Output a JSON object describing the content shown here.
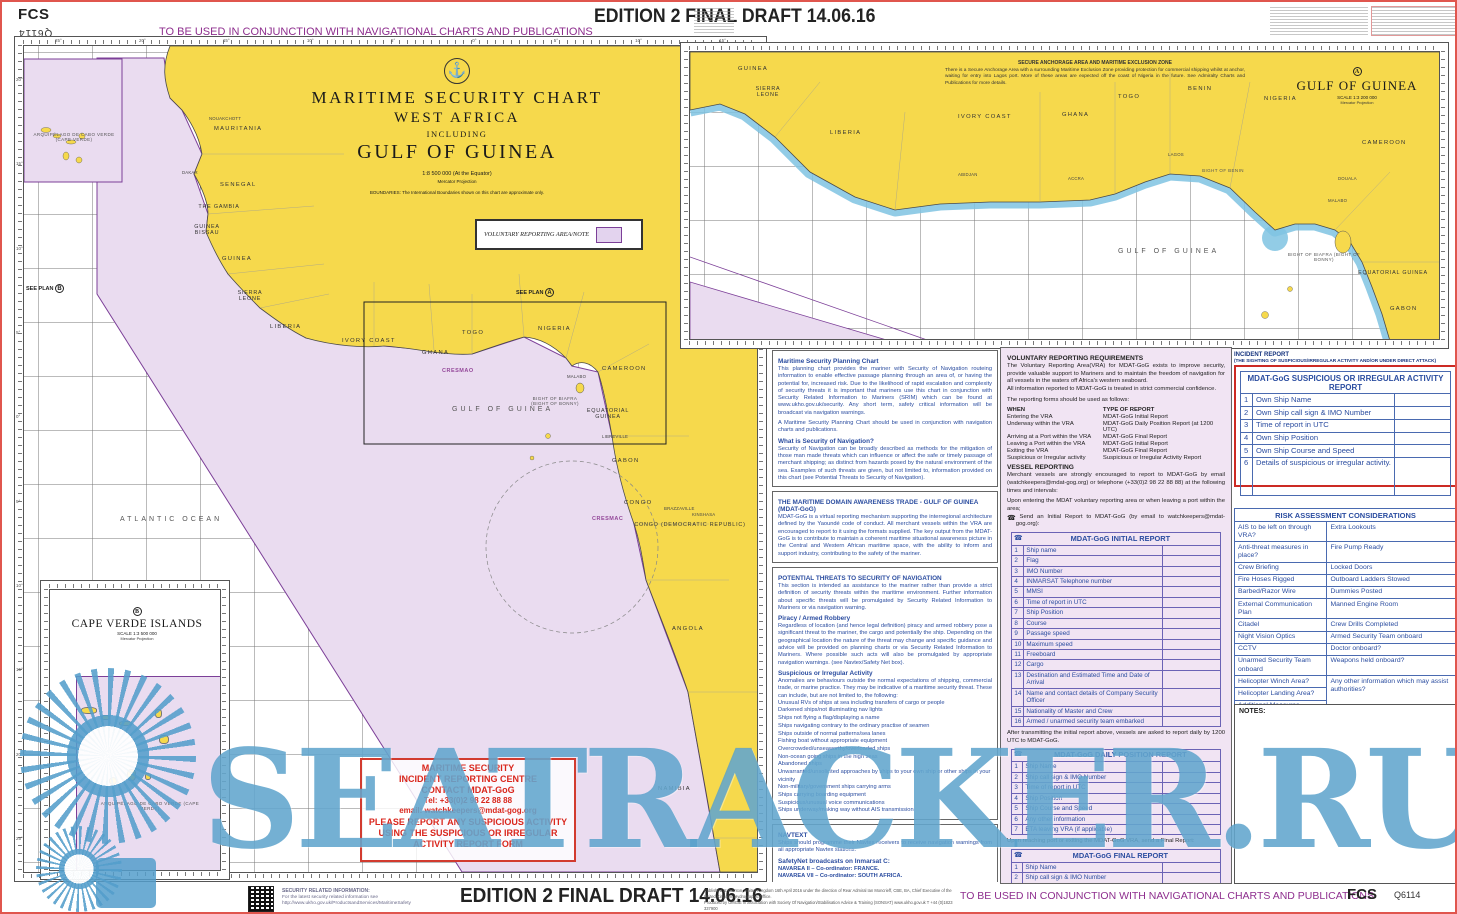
{
  "header": {
    "fcs": "FCS",
    "chart_number": "Q6114",
    "edition": "EDITION 2 FINAL DRAFT 14.06.16",
    "usage_note": "TO BE USED IN CONJUNCTION WITH NAVIGATIONAL CHARTS AND PUBLICATIONS"
  },
  "title_block": {
    "line1": "MARITIME SECURITY CHART",
    "line2": "WEST AFRICA",
    "line3": "INCLUDING",
    "line4": "GULF OF GUINEA",
    "scale": "1:8 500 000 (At the Equator)",
    "projection": "Mercator Projection",
    "boundaries": "BOUNDARIES:  The International Boundaries shown on this chart are approximate only.",
    "anchor_icon": "⚓"
  },
  "legend_box": {
    "label": "VOLUNTARY REPORTING AREA/NOTE"
  },
  "main_map": {
    "labels": [
      "MAURITANIA",
      "NOUAKCHOTT",
      "SENEGAL",
      "DAKAR",
      "THE GAMBIA",
      "GUINEA BISSAU",
      "GUINEA",
      "SIERRA LEONE",
      "LIBERIA",
      "IVORY COAST",
      "GHANA",
      "TOGO",
      "NIGERIA",
      "CAMEROON",
      "MALABO",
      "BIGHT OF BIAFRA (BIGHT OF BONNY)",
      "EQUATORIAL GUINEA",
      "LIBREVILLE",
      "GABON",
      "CONGO",
      "BRAZZAVILLE",
      "KINSHASA",
      "CONGO (DEMOCRATIC REPUBLIC)",
      "CRESMAC",
      "CRESMAO",
      "ANGOLA",
      "NAMIBIA",
      "GULF OF GUINEA",
      "ATLANTIC OCEAN",
      "ARQUIPÉLAGO DE CABO VERDE (CAPE VERDE)"
    ],
    "see_plan": "SEE PLAN",
    "plan_a_badge": "A",
    "plan_b_badge": "B",
    "lon_labels": [
      "25°",
      "20°",
      "15°",
      "10°",
      "5°",
      "0°",
      "5°",
      "10°",
      "15°"
    ],
    "lat_labels": [
      "20°",
      "15°",
      "10°",
      "5°",
      "0°",
      "5°",
      "10°",
      "15°",
      "20°",
      "25°"
    ]
  },
  "inset_a": {
    "badge": "A",
    "title": "GULF OF GUINEA",
    "scale": "SCALE 1:3 200 000",
    "projection": "Mercator Projection",
    "note_title": "SECURE ANCHORAGE AREA AND MARITIME EXCLUSION ZONE",
    "note_body": "There is a Secure Anchorage Area with a surrounding Maritime Exclusion Zone providing protection for commercial shipping whilst at anchor, waiting for entry into Lagos port. More of these areas are expected off the coast of Nigeria in the future. See Admiralty Charts and Publications for more details.",
    "labels": [
      "GUINEA",
      "SIERRA LEONE",
      "LIBERIA",
      "IVORY COAST",
      "GHANA",
      "TOGO",
      "BENIN",
      "NIGERIA",
      "CAMEROON",
      "BIGHT OF BENIN",
      "MALABO",
      "GULF OF GUINEA",
      "BIGHT OF BIAFRA (BIGHT OF BONNY)",
      "EQUATORIAL GUINEA",
      "GABON",
      "ABIDJAN",
      "ACCRA",
      "LAGOS",
      "DOUALA"
    ]
  },
  "inset_b": {
    "badge": "B",
    "title": "CAPE VERDE ISLANDS",
    "scale": "SCALE 1:3 500 000",
    "projection": "Mercator Projection",
    "islands_label": "ARQUIPÉLAGO DE CABO VERDE (CAPE VERDE)"
  },
  "info_panel": {
    "s1_title": "Maritime Security Planning Chart",
    "s1_body": "This planning chart provides the mariner with Security of Navigation routeing information to enable effective passage planning through an area of, or having the potential for, increased risk. Due to the likelihood of rapid escalation and complexity of security threats it is important that mariners use this chart in conjunction with Security Related Information to Mariners (SRIM) which can be found at www.ukho.gov.uk/security. Any short term, safety critical information will be broadcast via navigation warnings.",
    "s1_body2": "A Maritime Security Planning Chart should be used in conjunction with navigation charts and publications.",
    "s2_title": "What is Security of Navigation?",
    "s2_body": "Security of Navigation can be broadly described as methods for the mitigation of those man made threats which can influence or affect the safe or timely passage of merchant shipping; as distinct from hazards posed by the natural environment of the sea. Examples of such threats are given, but not limited to, information provided on this chart (see Potential Threats to Security of Navigation).",
    "s3_title": "THE MARITIME DOMAIN AWARENESS TRADE - GULF OF GUINEA (MDAT-GoG)",
    "s3_body": "MDAT-GoG is a virtual reporting mechanism supporting the interregional architecture defined by the Yaoundé code of conduct. All merchant vessels within the VRA are encouraged to report to it using the formats supplied. The key output from the MDAT-GoG is to contribute to maintain a coherent maritime situational awareness picture in the Central and Western African maritime space, with the ability to inform and support industry, contributing to the safety of the mariner.",
    "s4_title": "POTENTIAL THREATS TO SECURITY OF NAVIGATION",
    "s4_body": "This section is intended as assistance to the mariner rather than provide a strict definition of security threats within the maritime environment. Further information about specific threats will be promulgated by Security Related Information to Mariners or via navigation warning.",
    "s5_title": "Piracy / Armed Robbery",
    "s5_body": "Regardless of location (and hence legal definition) piracy and armed robbery pose a significant threat to the mariner, the cargo and potentially the ship. Depending on the geographical location the nature of the threat may change and specific guidance and advice will be provided on planning charts or via Security Related Information to Mariners. Where possible such acts will also be promulgated by appropriate navigation warnings. (see Navtex/Safety Net box).",
    "s6_title": "Suspicious or Irregular Activity",
    "s6_body": "Anomalies are behaviours outside the normal expectations of shipping, commercial trade, or marine practice. They may be indicative of a maritime security threat. These can include, but are not limited to, the following:",
    "s6_items": [
      "Unusual RVs of ships at sea including transfers of cargo or people",
      "Darkened ships/not illuminating nav lights",
      "Ships not flying a flag/displaying a name",
      "Ships navigating contrary to the ordinary practise of seamen",
      "Ships outside of normal patterns/sea lanes",
      "Fishing boat without appropriate equipment",
      "Overcrowded/unseaworthy/overloaded ships",
      "Non-ocean going ships in the high seas",
      "Abandoned ships",
      "Unwarranted/unsolicited approaches by ships to your own ship or other ships in your vicinity",
      "Non-military/government ships carrying arms",
      "Ships carrying boarding equipment",
      "Suspicious/unusual voice communications",
      "Ships underway/making way without AIS transmission"
    ],
    "s7_title": "NAVTEXT",
    "s7_body": "Ships should programme their Navtex receivers to receive navigation warnings from all appropriate Navtex stations.",
    "s7_sub": "SafetyNet broadcasts on Inmarsat C:",
    "s7_navarea2": "NAVAREA II – Co-ordinator: FRANCE.",
    "s7_navarea7": "NAVAREA VII – Co-ordinator: SOUTH AFRICA.",
    "s7_body2": "See Admiralty List of Radio Signals (ALRS) Volume 5 (NP285) for full details, scheduled transmission times, etc.",
    "s7_body3": "Ships in the Maritime Domain Awareness Trade - Gulf of Guinea Voluntary Reporting Area (MDAT-GoG VRA) should ensure that their Inmarsat C terminals are set to recieve navigational warnings from both NAVAREA II and VII to be sure that they recieve all of the relevant navigational warnings."
  },
  "reporting": {
    "title": "VOLUNTARY REPORTING REQUIREMENTS",
    "intro": "The Voluntary Reporting Area(VRA) for MDAT-GoG exists to improve security, provide valuable support to Mariners and to maintain the freedom of navigation for all vessels in the waters off Africa's western seaboard.",
    "intro2": "All information reported to MDAT-GoG is treated in strict commercial confidence.",
    "forms_intro": "The reporting forms should be used as follows:",
    "when_header": "WHEN",
    "type_header": "TYPE OF REPORT",
    "when_rows": [
      [
        "Entering the VRA",
        "MDAT-GoG Initial Report"
      ],
      [
        "Underway within the VRA",
        "MDAT-GoG Daily Position Report (at 1200 UTC)"
      ],
      [
        "Arriving at a Port within the VRA",
        "MDAT-GoG Final Report"
      ],
      [
        "Leaving a Port within the VRA",
        "MDAT-GoG Initial Report"
      ],
      [
        "Exiting the VRA",
        "MDAT-GoG Final Report"
      ],
      [
        "Suspicious or Irregular activity",
        "Suspicious or Irregular Activity Report"
      ]
    ],
    "vessel_title": "VESSEL REPORTING",
    "vessel_body": "Merchant vessels are strongly encouraged to report to MDAT-GoG by email (watchkeepers@mdat-gog.org) or telephone (+33(0)2 98 22 88 88) at the following times and intervals:",
    "upon_entering": "Upon entering the MDAT voluntary reporting area or when leaving a port within the area;",
    "send_initial": "Send an Initial Report to MDAT-GoG (by email to watchkeepers@mdat-gog.org):",
    "initial": {
      "title": "MDAT-GoG INITIAL REPORT",
      "rows": [
        [
          "1",
          "Ship name"
        ],
        [
          "2",
          "Flag"
        ],
        [
          "3",
          "IMO Number"
        ],
        [
          "4",
          "INMARSAT  Telephone number"
        ],
        [
          "5",
          "MMSI"
        ],
        [
          "6",
          "Time of report in UTC"
        ],
        [
          "7",
          "Ship Position"
        ],
        [
          "8",
          "Course"
        ],
        [
          "9",
          "Passage speed"
        ],
        [
          "10",
          "Maximum speed"
        ],
        [
          "11",
          "Freeboard"
        ],
        [
          "12",
          "Cargo"
        ],
        [
          "13",
          "Destination and Estimated Time and Date of Arrival"
        ],
        [
          "14",
          "Name and contact details of Company Security Officer"
        ],
        [
          "15",
          "Nationality of Master and Crew"
        ],
        [
          "16",
          "Armed / unarmed security team embarked"
        ]
      ]
    },
    "after_initial": "After transmitting the initial report above, vessels are asked to report daily by 1200 UTC to MDAT-GoG.",
    "daily": {
      "title": "MDAT-GoG DAILY POSITION REPORT",
      "rows": [
        [
          "1",
          "Ship Name"
        ],
        [
          "2",
          "Ship call sign & IMO Number"
        ],
        [
          "3",
          "Time of report in UTC"
        ],
        [
          "4",
          "Ship Position"
        ],
        [
          "5",
          "Ship Course and Speed"
        ],
        [
          "6",
          "Any other information"
        ],
        [
          "7",
          "ETA leaving VRA (if applicable)"
        ]
      ]
    },
    "upon_reaching": "Upon reaching port or exiting the MDAT-GoG VRA, send a Final Report:",
    "final": {
      "title": "MDAT-GoG FINAL REPORT",
      "rows": [
        [
          "1",
          "Ship Name"
        ],
        [
          "2",
          "Ship call sign & IMO Number"
        ],
        [
          "3",
          "Time of report in UTC"
        ],
        [
          "4",
          "Port/anchorage, or position when leaving GoG VRA"
        ]
      ]
    }
  },
  "incident": {
    "title": "INCIDENT REPORT",
    "subtitle": "(THE SIGHTING OF SUSPICIOUS/IRREGULAR ACTIVITY AND/OR UNDER DIRECT ATTACK)",
    "table_title": "MDAT-GoG SUSPICIOUS OR IRREGULAR ACTIVITY REPORT",
    "rows": [
      [
        "1",
        "Own Ship Name"
      ],
      [
        "2",
        "Own Ship call sign & IMO Number"
      ],
      [
        "3",
        "Time of report in UTC"
      ],
      [
        "4",
        "Own Ship Position"
      ],
      [
        "5",
        "Own Ship Course and Speed"
      ],
      [
        "6",
        "Details of suspicious or irregular activity."
      ]
    ]
  },
  "risk": {
    "title": "RISK ASSESSMENT CONSIDERATIONS",
    "rows": [
      [
        "AIS to be left on through VRA?",
        "Extra Lookouts"
      ],
      [
        "Anti-threat measures in place?",
        "Fire Pump Ready"
      ],
      [
        "Crew Briefing",
        "Locked Doors"
      ],
      [
        "Fire Hoses Rigged",
        "Outboard Ladders Stowed"
      ],
      [
        "Barbed/Razor Wire",
        "Dummies Posted"
      ],
      [
        "External Communication Plan",
        "Manned Engine Room"
      ],
      [
        "Citadel",
        "Crew Drills Completed"
      ],
      [
        "Night Vision Optics",
        "Armed Security Team onboard"
      ],
      [
        "CCTV",
        "Doctor onboard?"
      ],
      [
        "Unarmed Security Team onboard",
        "Weapons held onboard?"
      ],
      [
        "Helicopter Winch Area?",
        {
          "t": "Any other information which may assist authorities?",
          "rs": 3
        }
      ],
      [
        "Helicopter Landing Area?",
        null
      ],
      [
        "Additional Measures",
        null
      ]
    ]
  },
  "notes_label": "NOTES:",
  "contact_box": {
    "l1": "MARITIME SECURITY",
    "l2": "INCIDENT REPORTING CENTRE",
    "l3": "CONTACT MDAT-GoG",
    "l4": "Tel: +33(0)2 98 22 88 88",
    "l5": "email: watchkeepers@mdat-gog.org",
    "l6": "PLEASE REPORT ANY SUSPICIOUS ACTIVITY",
    "l7": "USING THE SUSPICIOUS OR IRREGULAR",
    "l8": "ACTIVITY REPORT FORM"
  },
  "footer": {
    "security_title": "SECURITY RELATED INFORMATION:",
    "security_body": "For the latest security related information see",
    "security_url": "http://www.ukho.gov.uk/ProductsandServices/MaritimeSafety",
    "edition": "EDITION 2 FINAL DRAFT 14.06.16",
    "pub1": "Published at Taunton, United Kingdom 16th April 2016 under the direction of Rear Admiral Ian Moncrieff, CBE, BA, Chief Executive of the United Kingdom Hydrographic Office.",
    "pub2": "Produced by OMGIE in association with Society Of Navigation/Stabilisation Advice & Training (SONSAT)   www.ukho.gov.uk   T +44 (0)1823 337900",
    "usage_note": "TO BE USED IN CONJUNCTION WITH NAVIGATIONAL CHARTS AND PUBLICATIONS",
    "fcs": "FCS",
    "chart_number": "Q6114"
  },
  "watermark": {
    "text": "SEATRACKER.RU"
  },
  "colors": {
    "land": "#F6D94C",
    "vra": "#EADCF0",
    "vra_border": "#7C3F98",
    "coastal_blue": "#7FC3E2",
    "accent_purple": "#8E2E8E",
    "alert_red": "#D9261C",
    "table_blue": "#2B4DA0",
    "watermark_blue": "#58A0CA"
  }
}
